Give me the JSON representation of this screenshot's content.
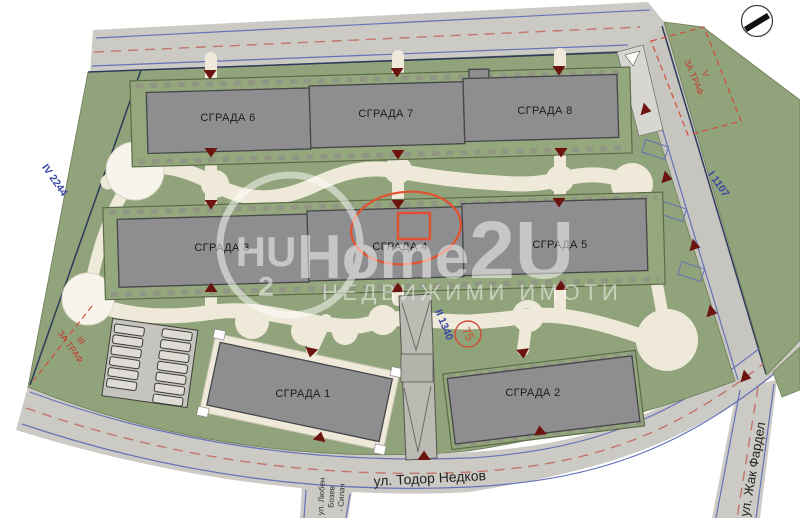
{
  "site_plan": {
    "buildings": [
      {
        "label": "СГРАДА 1"
      },
      {
        "label": "СГРАДА 2"
      },
      {
        "label": "СГРАДА 3"
      },
      {
        "label": "СГРАДА 4"
      },
      {
        "label": "СГРАДА 5"
      },
      {
        "label": "СГРАДА 6"
      },
      {
        "label": "СГРАДА 7"
      },
      {
        "label": "СГРАДА 8"
      }
    ],
    "streets": {
      "bottom": "ул. Тодор Недков",
      "right_branch": "ул. Жак Фардел",
      "left_branch_lines": [
        "ул. Любен",
        "Бозев",
        "- Силач"
      ]
    },
    "parcel_labels": {
      "west": "IV 2244",
      "east": "I 1107",
      "south_center": "II 1340",
      "unit_circle": "75",
      "northeast_lines": [
        "V",
        "ЗА ТРАФ."
      ],
      "southwest_lines": [
        "III",
        "ЗА ТРАФ."
      ]
    },
    "watermark": {
      "logo_letters": "HU",
      "logo_digit": "2",
      "brand_main": "Home",
      "brand_suffix": "2U",
      "subtitle": "НЕДВИЖИМИ ИМОТИ"
    },
    "icons": {
      "compass": "north-arrow-compass-icon"
    },
    "colors": {
      "site_green": "#90a37a",
      "road_gray": "#cbcac4",
      "building_gray": "#8e8e90",
      "path_cream": "#efe9da",
      "road_edge_blue": "#6672b8",
      "centerline_red": "#c4756b",
      "marker_dark_red": "#6b1410",
      "highlight_red": "#e2512e",
      "parcel_text_blue": "#3847a5",
      "parcel_text_red": "#c23b2e"
    }
  }
}
